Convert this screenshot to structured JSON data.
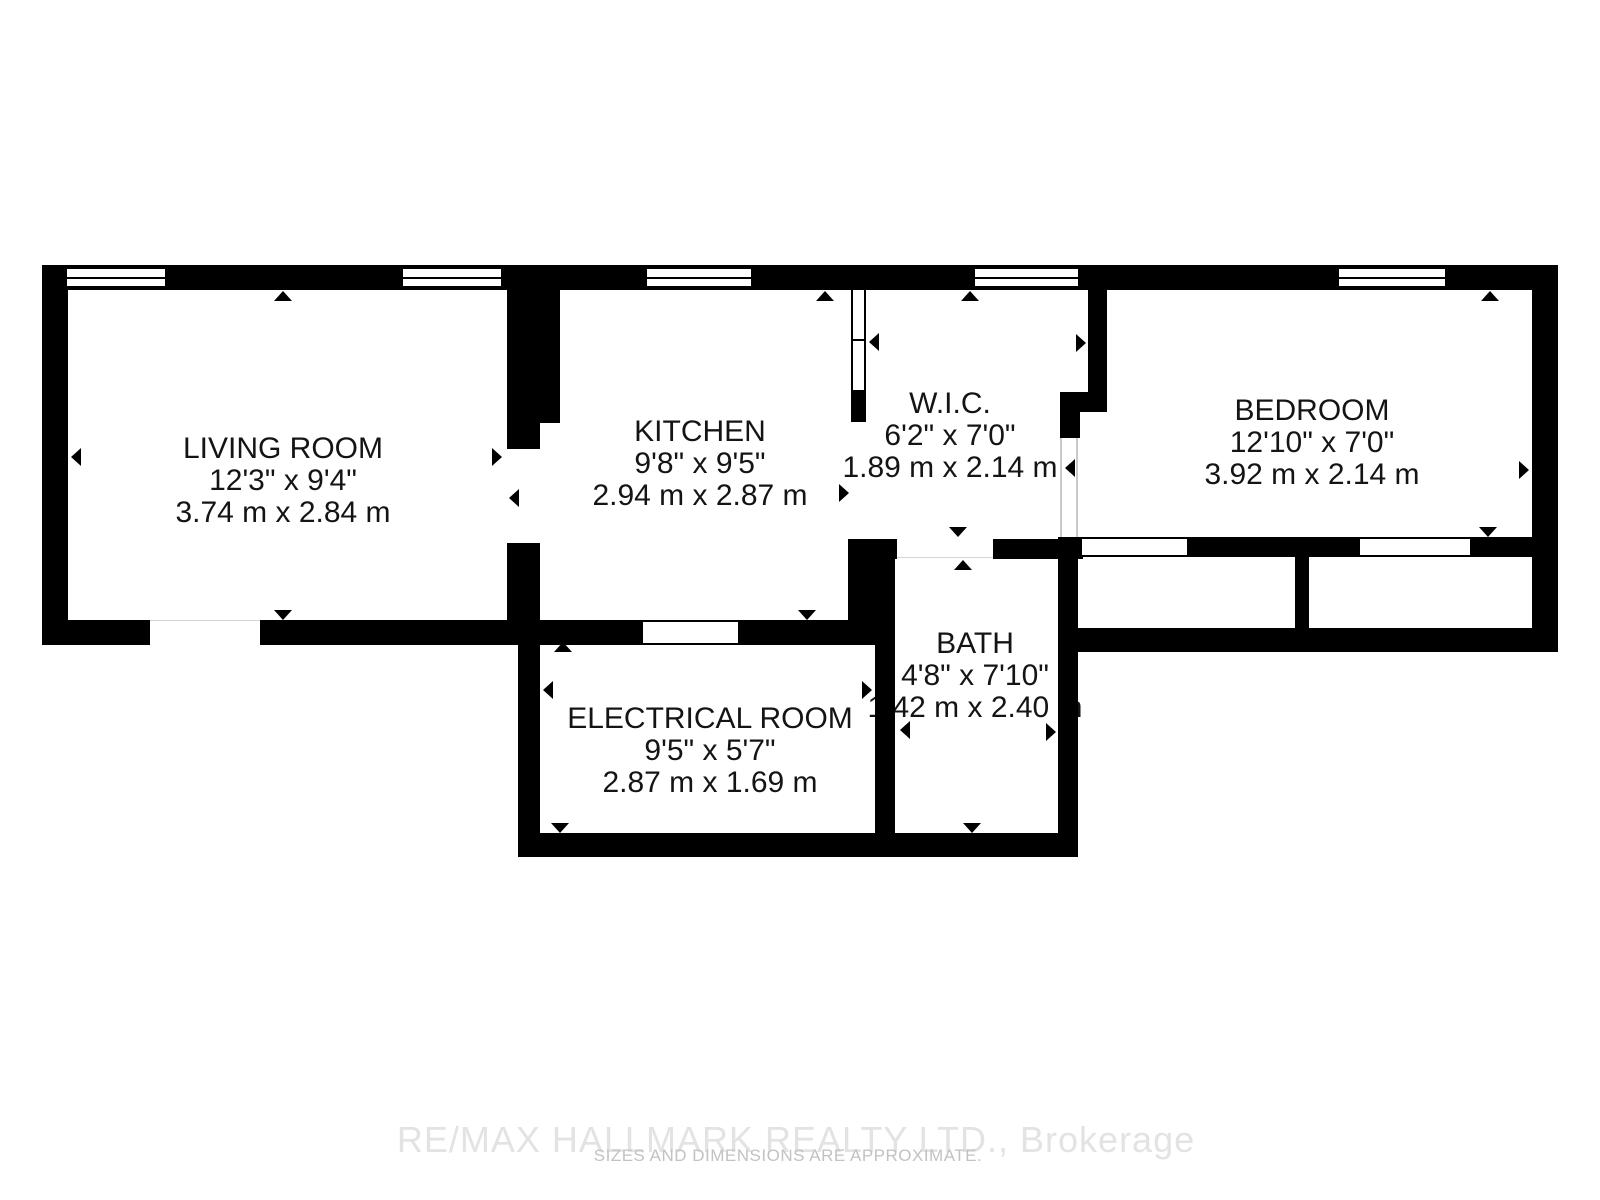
{
  "plan": {
    "type": "floor-plan",
    "colors": {
      "wall": "#000000",
      "label_text": "#141414",
      "watermark": "#e3e3e3",
      "disclaimer": "#c2c2c2"
    },
    "rooms": [
      {
        "id": "living-room",
        "name": "LIVING ROOM",
        "imperial": "12'3\" x 9'4\"",
        "metric": "3.74 m x 2.84 m"
      },
      {
        "id": "kitchen",
        "name": "KITCHEN",
        "imperial": "9'8\" x 9'5\"",
        "metric": "2.94 m x 2.87 m"
      },
      {
        "id": "wic",
        "name": "W.I.C.",
        "imperial": "6'2\" x 7'0\"",
        "metric": "1.89 m x 2.14 m"
      },
      {
        "id": "bedroom",
        "name": "BEDROOM",
        "imperial": "12'10\" x 7'0\"",
        "metric": "3.92 m x 2.14 m"
      },
      {
        "id": "bath",
        "name": "BATH",
        "imperial": "4'8\" x 7'10\"",
        "metric": "1.42 m x 2.40 m"
      },
      {
        "id": "electrical-room",
        "name": "ELECTRICAL ROOM",
        "imperial": "9'5\" x 5'7\"",
        "metric": "2.87 m x 1.69 m"
      }
    ]
  },
  "footer": {
    "brokerage": "RE/MAX HALLMARK REALTY LTD., Brokerage",
    "disclaimer": "SIZES AND DIMENSIONS ARE APPROXIMATE."
  }
}
